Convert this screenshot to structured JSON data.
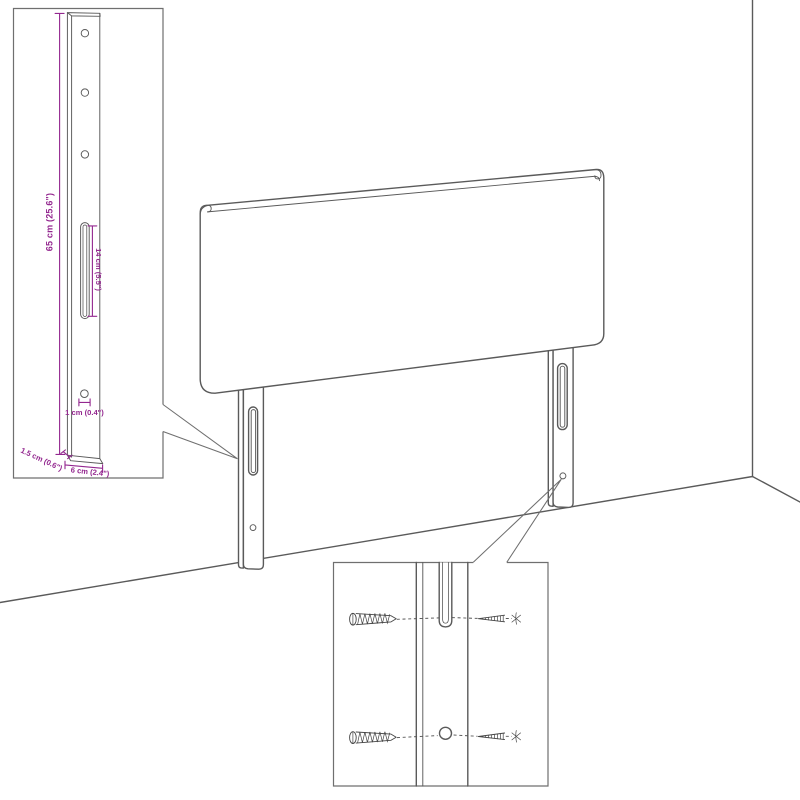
{
  "colors": {
    "accent": "#93278f",
    "line": "#5a5a5a",
    "background": "#ffffff"
  },
  "dimensions": {
    "leg_height": "65 cm (25.6\")",
    "slot_length": "14 cm (5.5\")",
    "hole_diameter": "1 cm (0.4\")",
    "leg_thickness": "1.5 cm (0.6\")",
    "leg_width": "6 cm (2.4\")"
  }
}
